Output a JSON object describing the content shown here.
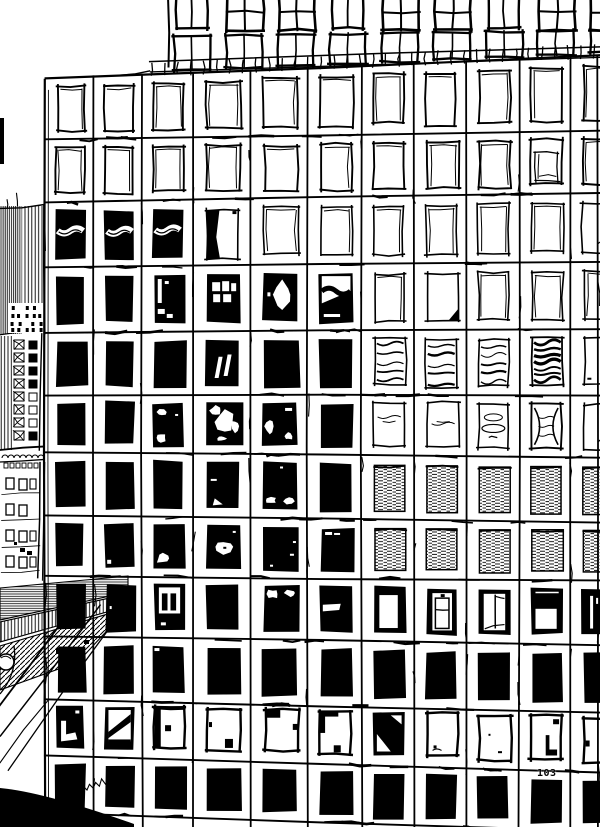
{
  "artwork": {
    "title": "Skyscraper facade ink drawing",
    "medium": "black ink line drawing on white paper",
    "page_number": "103",
    "ink_color": "#000000",
    "paper_color": "#ffffff"
  },
  "facade": {
    "columns": 11,
    "rows": 12,
    "window_states": [
      [
        "sketch",
        "sketch",
        "sketch",
        "sketch",
        "sketch",
        "sketch",
        "sketch",
        "sketch",
        "sketch",
        "sketch",
        "sketch"
      ],
      [
        "sketch",
        "sketch",
        "sketch",
        "sketch",
        "sketch",
        "sketch",
        "sketch",
        "sketch",
        "sketch",
        "inner_frame",
        "sketch"
      ],
      [
        "black_wave",
        "black_wave",
        "black_wave",
        "wedge_left",
        "sketch",
        "sketch",
        "sketch",
        "sketch",
        "sketch",
        "sketch",
        "squiggle_br"
      ],
      [
        "black",
        "black",
        "frame_marks",
        "white_blocks",
        "white_oval",
        "wave_top",
        "sketch",
        "corner_br",
        "sketch",
        "sketch",
        "sketch"
      ],
      [
        "black",
        "black",
        "black",
        "slashes",
        "black",
        "black",
        "waves",
        "waves",
        "waves",
        "waves_heavy",
        "tiny_marks"
      ],
      [
        "black",
        "black",
        "patches_left",
        "cloud_blobs",
        "patches_sides",
        "black",
        "squiggle",
        "squiggle",
        "ellipses",
        "bowtie",
        "squiggle_br"
      ],
      [
        "black",
        "black",
        "black",
        "specks",
        "bottom_blobs",
        "black",
        "hatch",
        "hatch",
        "hatch",
        "hatch",
        "hatch"
      ],
      [
        "black",
        "notch_bl",
        "blob_bl",
        "blob_center",
        "specks_r",
        "dash_tl",
        "hatch",
        "hatch",
        "hatch",
        "hatch",
        "hatch"
      ],
      [
        "black",
        "dot_l",
        "mullions",
        "black",
        "clouds_top",
        "band_mid",
        "thick_frame",
        "cabinet",
        "open_door",
        "flag",
        "slit"
      ],
      [
        "black",
        "black",
        "nick_tl",
        "black",
        "black",
        "black",
        "black",
        "black",
        "black",
        "black",
        "black"
      ],
      [
        "l_shape",
        "diag_black",
        "edge_left",
        "block_br",
        "corner_top",
        "frame_tl",
        "diag_white",
        "marks_bl",
        "marks_br",
        "j_corner",
        "mark_l"
      ],
      [
        "black",
        "black",
        "black",
        "black",
        "black",
        "black",
        "black",
        "black",
        "black",
        "black",
        "black"
      ]
    ],
    "state_legend": {
      "sketch": "clear window reflecting sky",
      "black": "dark window",
      "black_wave": "dark window with white wavy highlight",
      "hatch": "window reflecting rippled water texture",
      "waves": "window with wavy reflection lines",
      "squiggle": "clear window with faint squiggle reflection"
    }
  },
  "upper_tower": {
    "visible_window_rows": 2,
    "pane_layout": "2x2 panes",
    "railing": "balustrade with posts along roof parapet"
  },
  "neighbor_buildings": [
    {
      "name": "hatched-highrise",
      "texture": "dense vertical hatching"
    },
    {
      "name": "midrise-lattice",
      "texture": "small windows with X panes"
    },
    {
      "name": "lower-building",
      "texture": "paired small framed windows"
    },
    {
      "name": "street-canopy",
      "texture": "hatched sloping canopy with thin cables"
    },
    {
      "name": "foreground-wedge",
      "texture": "solid black corner shape with illegible handwritten signature above"
    }
  ]
}
